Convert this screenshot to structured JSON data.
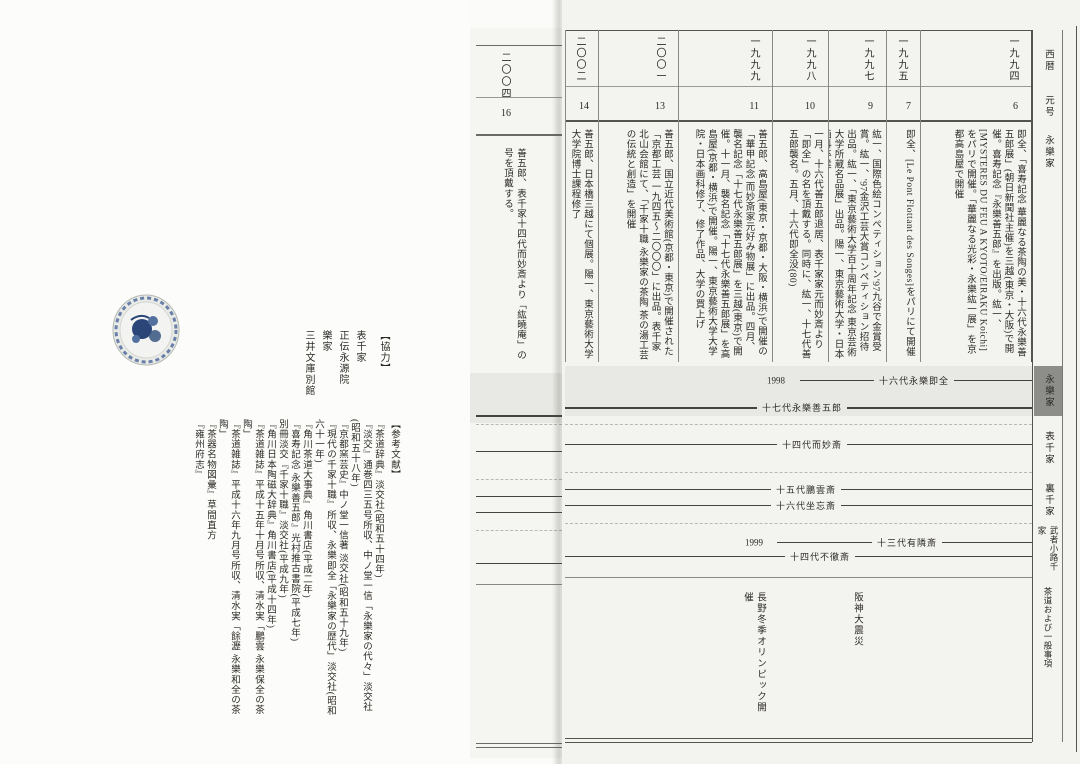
{
  "colors": {
    "canvas_bg": "#fbfbf9",
    "right_page_bg": "#f3f3f0",
    "band_bg": "#e8e8e4",
    "shaded_tab_bg": "#8d8d89",
    "line": "#45433e",
    "bowl_blue": "#2a4678"
  },
  "right_page": {
    "row_headers": {
      "year_row": "西暦",
      "era_row": "元号",
      "family_row": "永樂家"
    },
    "side_tabs": [
      {
        "label": "永樂家"
      },
      {
        "label": "表千家"
      },
      {
        "label": "裏千家"
      },
      {
        "label": "武者小路千家"
      },
      {
        "label": "茶道および一般事項"
      }
    ],
    "columns": [
      {
        "year": "一九九四",
        "era": "6",
        "text": "即全、「喜寿記念 華麗なる茶陶の美・十六代永樂善五郎展」(朝日新聞社主催)を三越(東京・大阪)で開催。喜寿記念『永樂善五郎』を出版。紘一、[MYSTERES DU FEU A KYOTO/EIRAKU Koichi]をパリで開催。「華麗なる光彩・永樂紘一展」を京都高島屋で開催"
      },
      {
        "year": "一九九五",
        "era": "7",
        "text": "即全、[Le Pont Flottant des Songes]をパリにて開催"
      },
      {
        "year": "一九九七",
        "era": "9",
        "text": "紘一、国際色絵コンペティション'97九谷で金賞受賞。紘一、'97金沢工芸大賞コンペティション招待出品。紘一、「東京藝術大学百十周年記念 東京芸術大学所蔵名品展」出品。陽一、東京藝術大学・日本画科卒業"
      },
      {
        "year": "一九九八",
        "era": "10",
        "text": "一月、十六代善五郎退居、表千家家元而妙斎より「即全」の名を頂戴する。同時に、紘一、十七代善五郎襲名。五月、十六代即全没(80)"
      },
      {
        "year": "一九九九",
        "era": "11",
        "text": "善五郎、高島屋(東京・京都・大阪・横浜)で開催の「華甲記念 而妙斎家元好み物展」に出品。四月、襲名記念「十七代永樂善五郎展」を三越(東京)で開催。十一月、襲名記念「十七代永樂善五郎展」を高島屋(京都・横浜)で開催。陽一、東京藝術大学大学院・日本画科修了、修了作品、大学の買上げ"
      },
      {
        "year": "二〇〇一",
        "era": "13",
        "text": "善五郎、国立近代美術館(京都・東京)で開催された「京都工芸 一九四五〜二〇〇〇」に出品。表千家北山会館にて、「千家十職 永樂家の茶陶 茶の湯工芸の伝統と創造」を開催"
      },
      {
        "year": "二〇〇二",
        "era": "14",
        "text": "善五郎、日本橋三越にて個展。陽一、東京藝術大学大学院博士課程修了"
      }
    ],
    "timeline": {
      "eiraku": [
        {
          "label": "十六代永樂即全",
          "end_label": "1998"
        },
        {
          "label": "十七代永樂善五郎"
        }
      ],
      "omotesenke": [
        {
          "label": "十四代而妙斎"
        }
      ],
      "urasenke": [
        {
          "label": "十五代鵬雲斎"
        },
        {
          "label": "十六代坐忘斎"
        }
      ],
      "mushakoji": [
        {
          "label": "十三代有隣斎",
          "end_label": "1999"
        },
        {
          "label": "十四代不徹斎"
        }
      ],
      "general_events": [
        {
          "text": "阪神大震災"
        },
        {
          "text": "長野冬季オリンピック開催"
        }
      ]
    }
  },
  "strip_page": {
    "year": "二〇〇四",
    "era": "16",
    "text": "善五郎、表千家十四代而妙斎より「紘曉庵」の号を頂戴する。"
  },
  "left_page": {
    "cooperation": {
      "heading": "【協力】",
      "items": [
        "表千家",
        "正伝永源院",
        "樂家",
        "三井文庫別館"
      ]
    },
    "references": {
      "heading": "【参考文献】",
      "items": [
        "『茶道辞典』淡交社(昭和五十四年)",
        "『淡交』通巻四三五号所収、中ノ堂一信「永樂家の代々」淡交社(昭和五十八年)",
        "『京都窯芸史』中ノ堂一信著 淡交社(昭和五十九年)",
        "『現代の千家十職』所収、永樂即全「永樂家の歴代」淡交社(昭和六十一年)",
        "『角川茶道大事典』角川書店(平成二年)",
        "『喜寿記念 永樂善五郎』光村推古書院(平成七年)",
        "別冊淡交『千家十職』淡交社(平成九年)",
        "『角川日本陶磁大辞典』角川書店(平成十四年)",
        "『茶道雑誌』平成十五年十月号所収、清水実「鵬雲 永樂保全の茶陶」",
        "『茶道雑誌』平成十六年九月号所収、清水実「餘瀝 永樂和全の茶陶」",
        "『茶器名物図彙』草間直方",
        "『雍州府志』"
      ]
    }
  }
}
